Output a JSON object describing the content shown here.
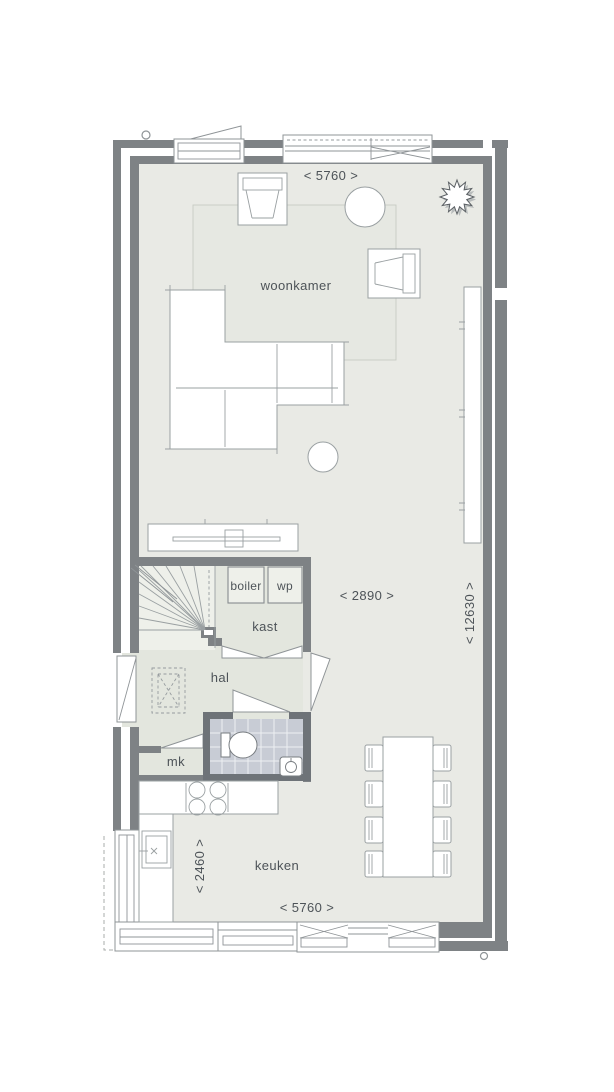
{
  "rooms": {
    "living": "woonkamer",
    "hall": "hal",
    "closet": "kast",
    "kitchen": "keuken",
    "meter_cupboard": "mk",
    "boiler": "boiler",
    "heat_pump": "wp"
  },
  "dimensions": {
    "top_width": "< 5760 >",
    "bottom_width": "< 5760 >",
    "living_width": "< 2890 >",
    "house_depth": "< 12630 >",
    "kitchen_width": "< 2460 >"
  },
  "icons": {
    "tree": "tree-icon"
  },
  "colors": {
    "wall": "#7e8285",
    "bathroom_wall": "#6e7378",
    "floor": "#e9eae5",
    "hall_floor": "#e3e6de",
    "stairs_floor": "#eef0ea",
    "bathroom_tile": "#c8ccd5",
    "carpet": "#e6e8e2",
    "furniture_outline": "#9aa0a2",
    "label_text": "#4d5358"
  }
}
